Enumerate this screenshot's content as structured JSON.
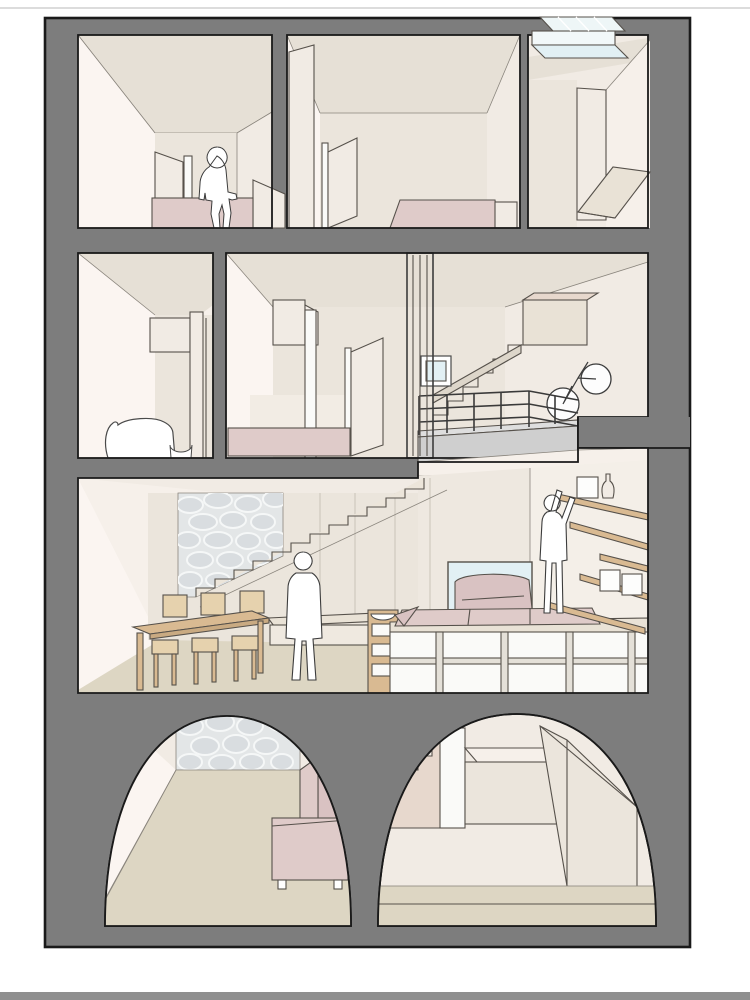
{
  "meta": {
    "kind": "architectural sectional perspective illustration",
    "description": "Cut-away cross-section of a four-level townhouse; cut walls rendered solid gray, interiors in warm off-whites with rose furniture and three white human silhouettes. No text appears in the image."
  },
  "palette": {
    "cut-gray": "#7d7d7d",
    "outline": "#1a1a1a",
    "wall-back": "#ebe5dc",
    "wall-ceiling": "#e6e0d6",
    "wall-side": "#f6f0ea",
    "wall-side-bright": "#fbf5f1",
    "wall-warm": "#f1ebe4",
    "floor-beige": "#ddd6c3",
    "pink": "#dfcbc9",
    "pink-deep": "#d9c2c2",
    "wood": "#d9ba92",
    "wood-light": "#e6d2ae",
    "wood-dark": "#c9aa82",
    "stone-bg": "#e3e6e7",
    "stone": "#d9dde0",
    "glass": "#e2f0f4",
    "skylight": "#eef6f7",
    "slab-gray": "#cfcfcf",
    "rail-dark": "#3a3a3a",
    "panel-joint": "#c9c3b9",
    "bottom-bar": "#8f8f8f"
  },
  "scene": {
    "floors": [
      {
        "label": "Top floor: bedroom with seated figure, second bedroom with wardrobe, skylit closet room with desk"
      },
      {
        "label": "Middle floor: study with white armchair, bedroom with open door, stair landing with railing and bicycle"
      },
      {
        "label": "Living floor: dining table with chairs, straight stair over stone wall, raised platform with storage drawers, shelf wall and reaching figure"
      },
      {
        "label": "Basement: two barrel-vaulted cellars, one with rose sofa and stone wall, one with stair and storage volumes"
      }
    ],
    "figures": [
      {
        "label": "person seated on bed, top floor"
      },
      {
        "label": "person standing in living room"
      },
      {
        "label": "person reaching up to wall shelves"
      }
    ],
    "furniture": [
      "bed",
      "wardrobe",
      "door leaves",
      "skylight",
      "desk",
      "white armchair",
      "platform bed",
      "glazed partition",
      "small window",
      "stair",
      "mezzanine railing",
      "bicycle",
      "dining table",
      "six chairs",
      "bowl shelf unit",
      "storage platform",
      "mattress cushions",
      "rose armchair",
      "floating shelves",
      "vase",
      "boxes",
      "rose sofa"
    ]
  }
}
